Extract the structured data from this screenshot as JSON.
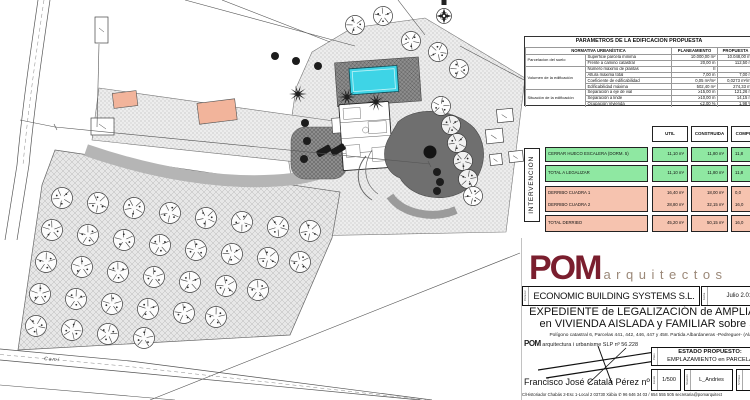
{
  "plan": {
    "road_label": "Camí"
  },
  "colors": {
    "green": "#8FE8A2",
    "pink": "#F6C3AF",
    "maroon": "#7A1E2E",
    "pool": "#3ED4E6"
  },
  "params": {
    "title": "PARAMETROS DE LA EDIFICACION PROPUESTA",
    "col_normativa": "NORMATIVA URBANÍSTICA",
    "col_planeamiento": "PLANEAMIENTO",
    "col_propuesta": "PROPUESTA",
    "groups": [
      {
        "name": "Parcelacion del suelo",
        "rows": [
          {
            "label": "Superficie parcela mínima",
            "plan": "10.000,00 m²",
            "prop": "10.048,00 m²"
          },
          {
            "label": "Frente a camino catastral",
            "plan": "20,00 m",
            "prop": "112,50 m"
          }
        ]
      },
      {
        "name": "Volumen de la edificación",
        "rows": [
          {
            "label": "Número máximo de plantas",
            "plan": "II",
            "prop": "II"
          },
          {
            "label": "Altura máxima total",
            "plan": "7,00 m",
            "prop": "7,00 m"
          },
          {
            "label": "Coeficiente de edificabilidad",
            "plan": "0,05 m²/m²",
            "prop": "0,0273 m²/m²"
          },
          {
            "label": "Edificabilidad máxima",
            "plan": "502,40 m²",
            "prop": "274,33 m²"
          }
        ]
      },
      {
        "name": "Situación de la edificación",
        "rows": [
          {
            "label": "Separación a eje de vial",
            "plan": "≥15,00 m",
            "prop": "121,26 m"
          },
          {
            "label": "Separación a linde",
            "plan": "≥10,00 m",
            "prop": "14,15 m"
          },
          {
            "label": "Ocupación Vivienda",
            "plan": "≤2,00 %",
            "prop": "1,98 %"
          }
        ]
      }
    ]
  },
  "intervencion": {
    "side_label": "INTERVENCION",
    "col_util": "UTIL",
    "col_construida": "CONSTRUIDA",
    "col_computable": "COMPUTABLE",
    "rows": [
      {
        "label": "CERRAR HUECO ESCALERA (DORM. 5)",
        "util": "11,10 m²",
        "construida": "11,80 m²",
        "computable": "11,8"
      },
      {
        "label": "TOTAL A LEGALIZAR",
        "util": "11,10 m²",
        "construida": "11,80 m²",
        "computable": "11,8"
      },
      {
        "label": "DERRIBO CUADRA 1",
        "util": "16,40 m²",
        "construida": "18,00 m²",
        "computable": "0,0"
      },
      {
        "label": "DERRIBO CUADRA 2",
        "util": "28,80 m²",
        "construida": "32,15 m²",
        "computable": "16,0"
      },
      {
        "label": "TOTAL DERRIBO",
        "util": "45,20 m²",
        "construida": "50,15 m²",
        "computable": "16,0"
      }
    ]
  },
  "titleblock": {
    "brand": "POM",
    "brand_suffix": "arquitectos",
    "promotor_label": "Promotor",
    "promotor": "ECONOMIC BUILDING SYSTEMS S.L.",
    "fecha_label": "Fecha",
    "fecha": "Julio 2.015",
    "title_line1": "EXPEDIENTE de LEGALIZACIÓN de AMPLIACIÓN",
    "title_line2": "en VIVIENDA AISLADA y FAMILIAR sobre SNU",
    "location": "Polígono catastral 6, Parcelas 441, 442, 446, 447 y 458. Partida Albardaneras  -Pedreguer- (Alacant)",
    "firm": "POM",
    "firm_rest": " arquitectura i urbanisme SLP nº 56.228",
    "architect": "Francisco José Catalá Pérez nº 6.695",
    "contact": "C/Historiador Chabás 2-Esc 1-Local 2 03730 Xàbia   ✆ 96 646 34 03 / 654 555 505   secretaria@pomarquitect",
    "plano_label": "Plano",
    "estado_line1": "ESTADO PROPUESTO:",
    "estado_line2": "EMPLAZAMIENTO en PARCELA",
    "escala_label": "Escala",
    "escala": "1/500",
    "ref_label": "Situación",
    "ref": "L_Andries",
    "num_label": "Nº Plano"
  }
}
